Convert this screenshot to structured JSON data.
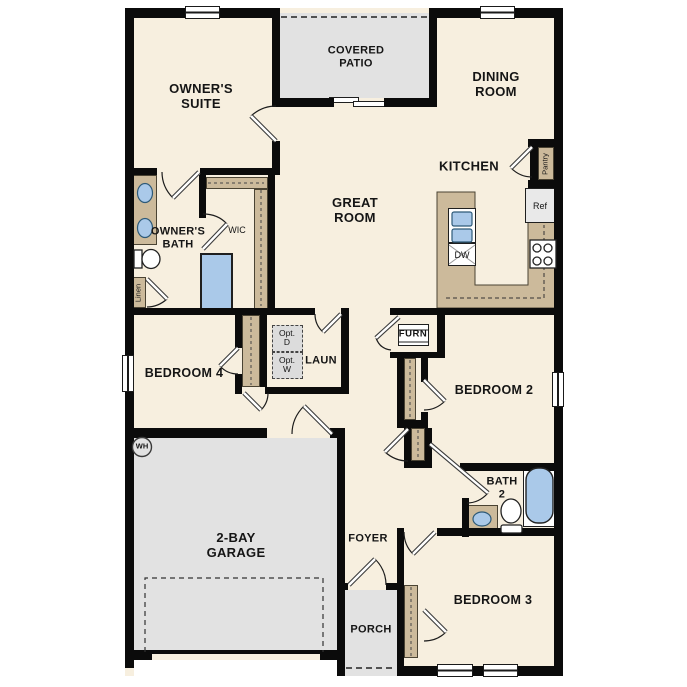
{
  "labels": {
    "owners_suite": "OWNER'S\nSUITE",
    "covered_patio": "COVERED\nPATIO",
    "dining_room": "DINING\nROOM",
    "kitchen": "KITCHEN",
    "great_room": "GREAT\nROOM",
    "owners_bath": "OWNER'S\nBATH",
    "wic": "WIC",
    "linen": "Linen",
    "pantry": "Pantry",
    "ref": "Ref",
    "dw": "DW",
    "opt_d": "Opt.\nD",
    "opt_w": "Opt.\nW",
    "laun": "LAUN",
    "furn": "FURN",
    "bedroom4": "BEDROOM 4",
    "bedroom2": "BEDROOM 2",
    "bath2": "BATH\n2",
    "wh": "WH",
    "garage": "2-BAY\nGARAGE",
    "foyer": "FOYER",
    "porch": "PORCH",
    "bedroom3": "BEDROOM 3"
  },
  "colors": {
    "floor": "#f7efdf",
    "wall": "#0b0b0b",
    "cabinet_tan": "#ccba9b",
    "area_gray": "#e2e2e2",
    "fixture_blue": "#aac9e9",
    "opt_gray": "#dcdcdc"
  }
}
